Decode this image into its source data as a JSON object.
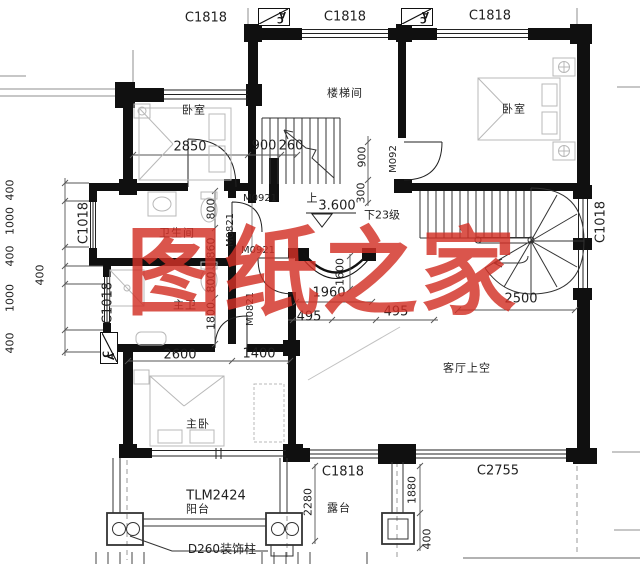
{
  "watermark": {
    "text": "图纸之家",
    "color": "#d33026"
  },
  "rooms": {
    "bedroom": "卧室",
    "stair_room": "楼梯间",
    "bathroom": "卫生间",
    "master_bathroom": "主卫",
    "master_bedroom": "主卧",
    "living_room_void": "客厅上空",
    "balcony": "阳台",
    "terrace": "露台"
  },
  "openings": {
    "window_c1818": "C1818",
    "window_c2755": "C2755",
    "window_c1018": "C1018",
    "balcony_door_tlm2424": "TLM2424",
    "door_m0921": "M0921",
    "door_m0821": "M0821",
    "door_m092": "M092"
  },
  "stairs": {
    "up_symbol": "上",
    "level": "3.600",
    "down_steps": "下23级"
  },
  "notes": {
    "decorative_column": "D260装饰柱"
  },
  "section_marks": {
    "letter_a": "A",
    "letter_c": "C"
  },
  "dimensions": {
    "d2850": "2850",
    "d900": "900",
    "d260": "260",
    "d300": "300",
    "d400": "400",
    "d1000": "1000",
    "d800": "800",
    "d860": "860",
    "d1800": "1800",
    "d2600": "2600",
    "d1400": "1400",
    "d1600": "1600",
    "d1960": "1960",
    "d495": "495",
    "d2500": "2500",
    "d2280": "2280",
    "d1880": "1880"
  }
}
